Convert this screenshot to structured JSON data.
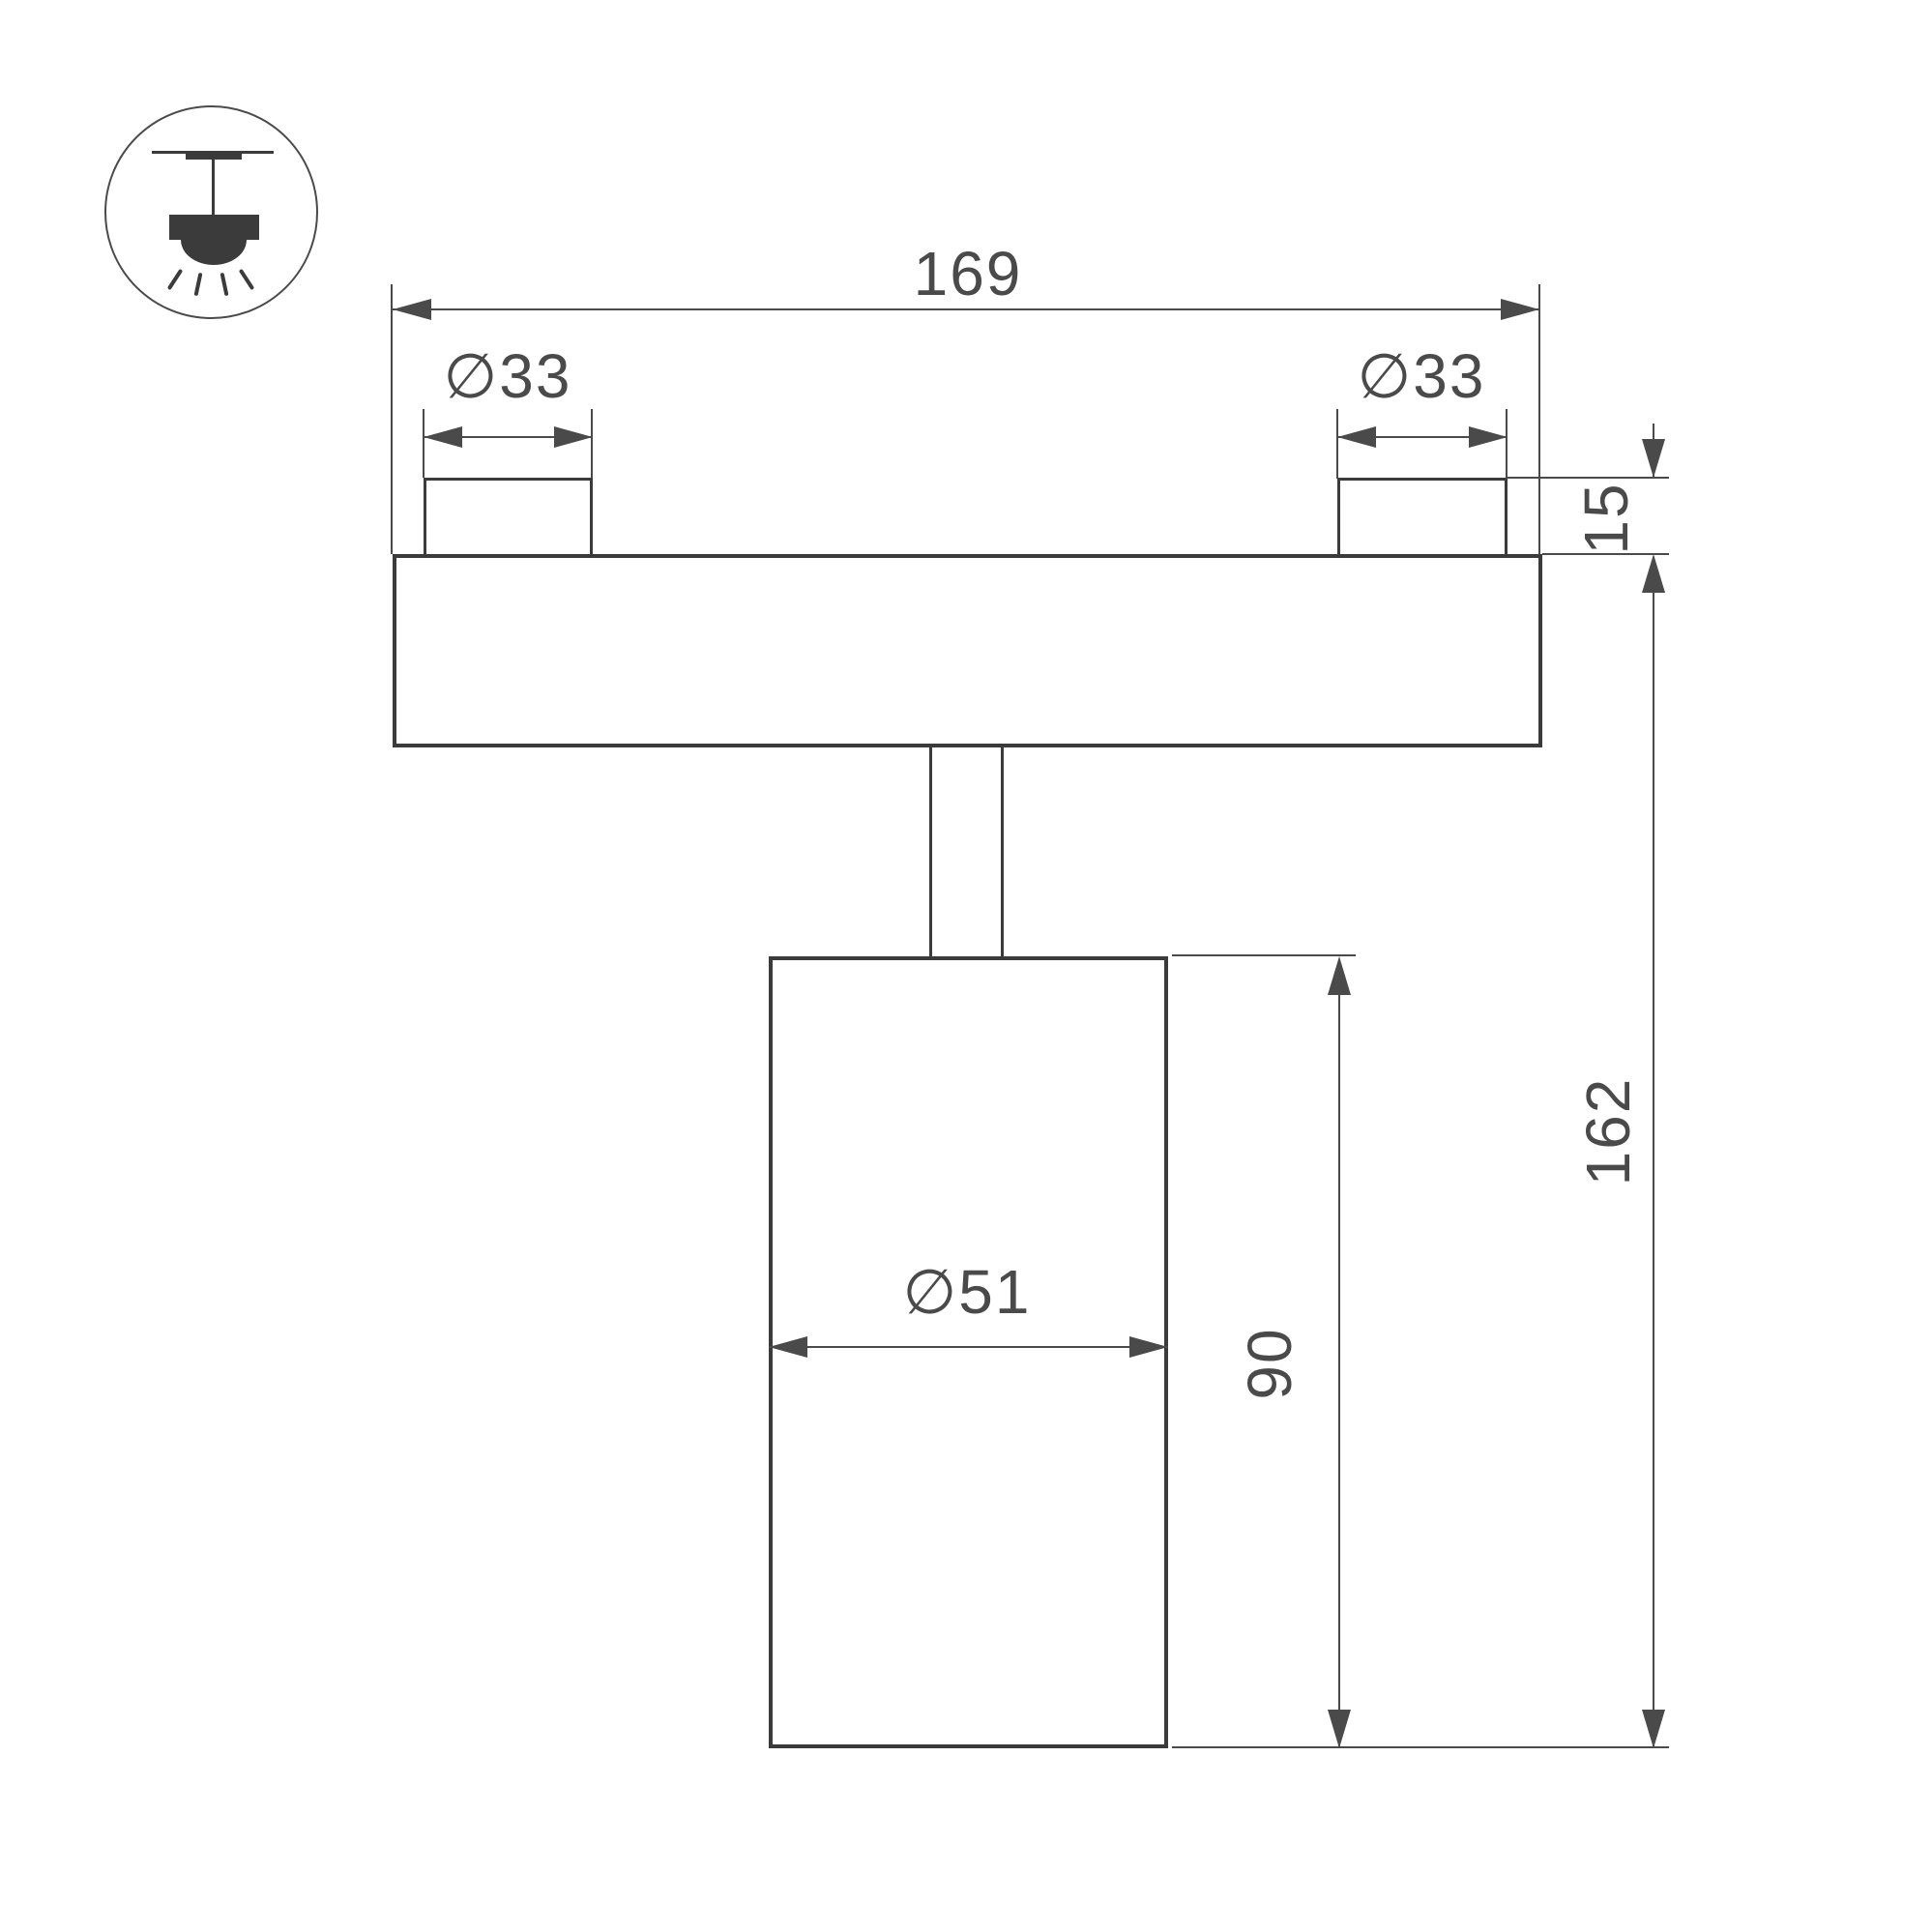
{
  "drawing": {
    "colors": {
      "background": "#ffffff",
      "stroke": "#3b3b3b",
      "dim": "#4a4a4a"
    },
    "icon": {
      "name": "ceiling-track-light-pictogram"
    },
    "dimensions": {
      "track_width": "169",
      "left_boss_diameter": "∅33",
      "right_boss_diameter": "∅33",
      "boss_height": "15",
      "overall_height": "162",
      "body_height": "90",
      "body_diameter": "∅51"
    }
  }
}
